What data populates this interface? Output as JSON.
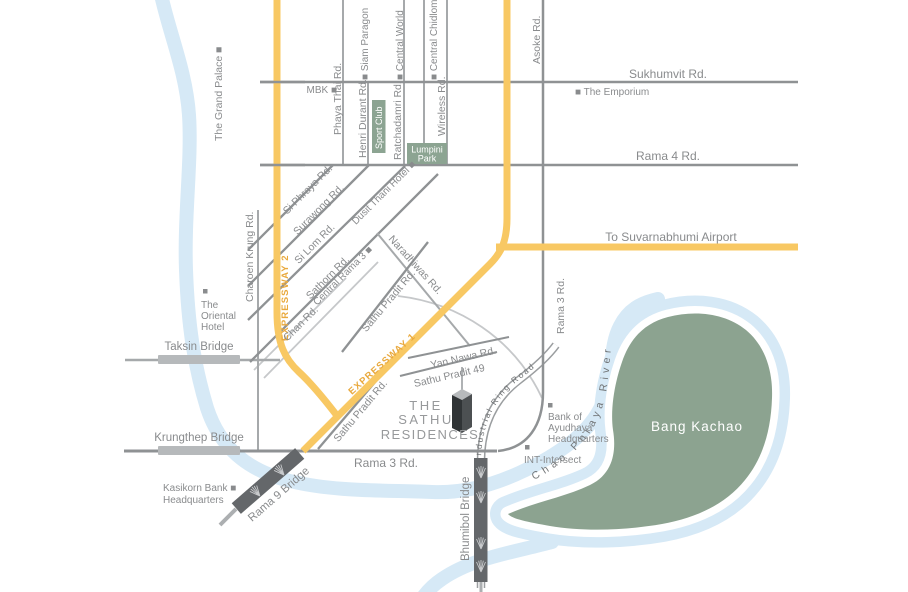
{
  "map": {
    "colors": {
      "expressway": "#F8C863",
      "expressway_text": "#E9A93D",
      "road_dark": "#8F9294",
      "road_mid": "#A6A9AB",
      "road_light": "#C6C8CA",
      "river": "#D6E9F6",
      "green_area": "#8CA390",
      "green_box": "#8CA492",
      "label_text": "#898B8D",
      "bridge_dark": "#64676A",
      "bridge_light": "#B6B9BB",
      "logo_text": "#97999B",
      "white": "#FFFFFF"
    },
    "logo": {
      "line1": "THE",
      "line2": "SATHU",
      "line3": "RESIDENCES"
    },
    "expressways": {
      "ew1": "EXPRESSWAY 1",
      "ew2": "EXPRESSWAY 2",
      "airport": "To Suvarnabhumi Airport"
    },
    "roads": {
      "sukhumvit": "Sukhumvit Rd.",
      "rama4": "Rama 4 Rd.",
      "asoke": "Asoke Rd.",
      "phaya_thai": "Phaya Thai Rd.",
      "henri_durant": "Henri Durant Rd.",
      "ratchadamri": "Ratchadamri Rd.",
      "wireless": "Wireless Rd.",
      "si_phraya": "Si Phraya Rd.",
      "surawong": "Surawong Rd.",
      "si_lom": "Si Lom Rd.",
      "sathorn": "Sathorn Rd.",
      "chan": "Chan Rd.",
      "charoen_krung": "Charoen Krung Rd.",
      "naradhiwas": "Naradhiwas Rd.",
      "sathu_pradit": "Sathu Pradit Rd.",
      "sathu_pradit_49": "Sathu Pradit 49",
      "yan_nawa": "Yan Nawa Rd.",
      "rama3": "Rama 3 Rd.",
      "industrial_ring": "Industrial Ring Road"
    },
    "bridges": {
      "taksin": "Taksin Bridge",
      "krungthep": "Krungthep Bridge",
      "rama9": "Rama 9 Bridge",
      "bhumibol": "Bhumibol Bridge"
    },
    "landmarks": {
      "grand_palace": "The Grand Palace ■",
      "mbk": "MBK ■",
      "siam_paragon": "■ Siam Paragon",
      "central_world": "■ Central World",
      "central_chidlom": "■ Central Chidlom",
      "emporium": "■ The Emporium",
      "sport_club": "Sport Club",
      "lumpini": [
        "Lumpini",
        "Park"
      ],
      "oriental": [
        "The",
        "Oriental",
        "Hotel"
      ],
      "dusit_thani": "Dusit Thani Hotel ■",
      "central_rama3": "Central Rama 3 ■",
      "kasikorn": [
        "Kasikorn Bank ■",
        "Headquarters"
      ],
      "bank_ayudhaya": [
        "Bank of",
        "Ayudhaya",
        "Headquarters"
      ],
      "int_intersect": "INT-Intersect",
      "bang_kachao": "Bang Kachao",
      "chao_phraya": "Chao Phraya River"
    }
  }
}
